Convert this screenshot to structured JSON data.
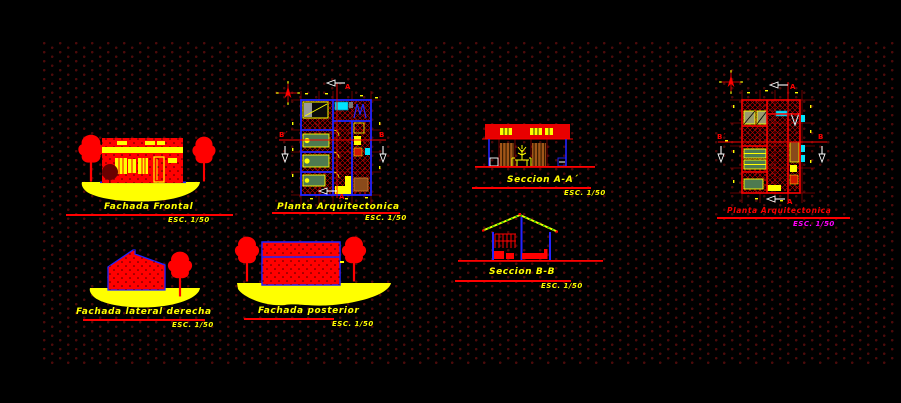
{
  "canvas": {
    "background": "#000000",
    "grid_dot_color": "#4c0a0a"
  },
  "palette": {
    "red": "#ff0000",
    "dark_red": "#c40000",
    "yellow": "#ffff00",
    "blue": "#2424ff",
    "cyan": "#00e5ff",
    "green": "#4e7a50",
    "gray": "#9a9a9a",
    "brown": "#8a4a1a",
    "olive": "#9a9a6e",
    "magenta": "#ff00ff"
  },
  "drawings": {
    "fachada_frontal": {
      "title": "Fachada Frontal",
      "scale": "ESC. 1/50"
    },
    "planta_arquitectonica": {
      "title": "Planta Arquitectonica",
      "scale": "ESC. 1/50"
    },
    "seccion_aa": {
      "title": "Seccion A-A´",
      "scale": "ESC. 1/50"
    },
    "seccion_bb": {
      "title": "Seccion B-B",
      "scale": "ESC. 1/50"
    },
    "fachada_lateral_derecha": {
      "title": "Fachada lateral derecha",
      "scale": "ESC. 1/50"
    },
    "fachada_posterior": {
      "title": "Fachada posterior",
      "scale": "ESC. 1/50"
    },
    "planta_arquitectonica_2": {
      "title": "Planta Arquitectonica",
      "scale": "ESC. 1/50"
    }
  },
  "markers": {
    "section_a": "A",
    "section_b_left": "B´",
    "section_b_right": "B"
  }
}
